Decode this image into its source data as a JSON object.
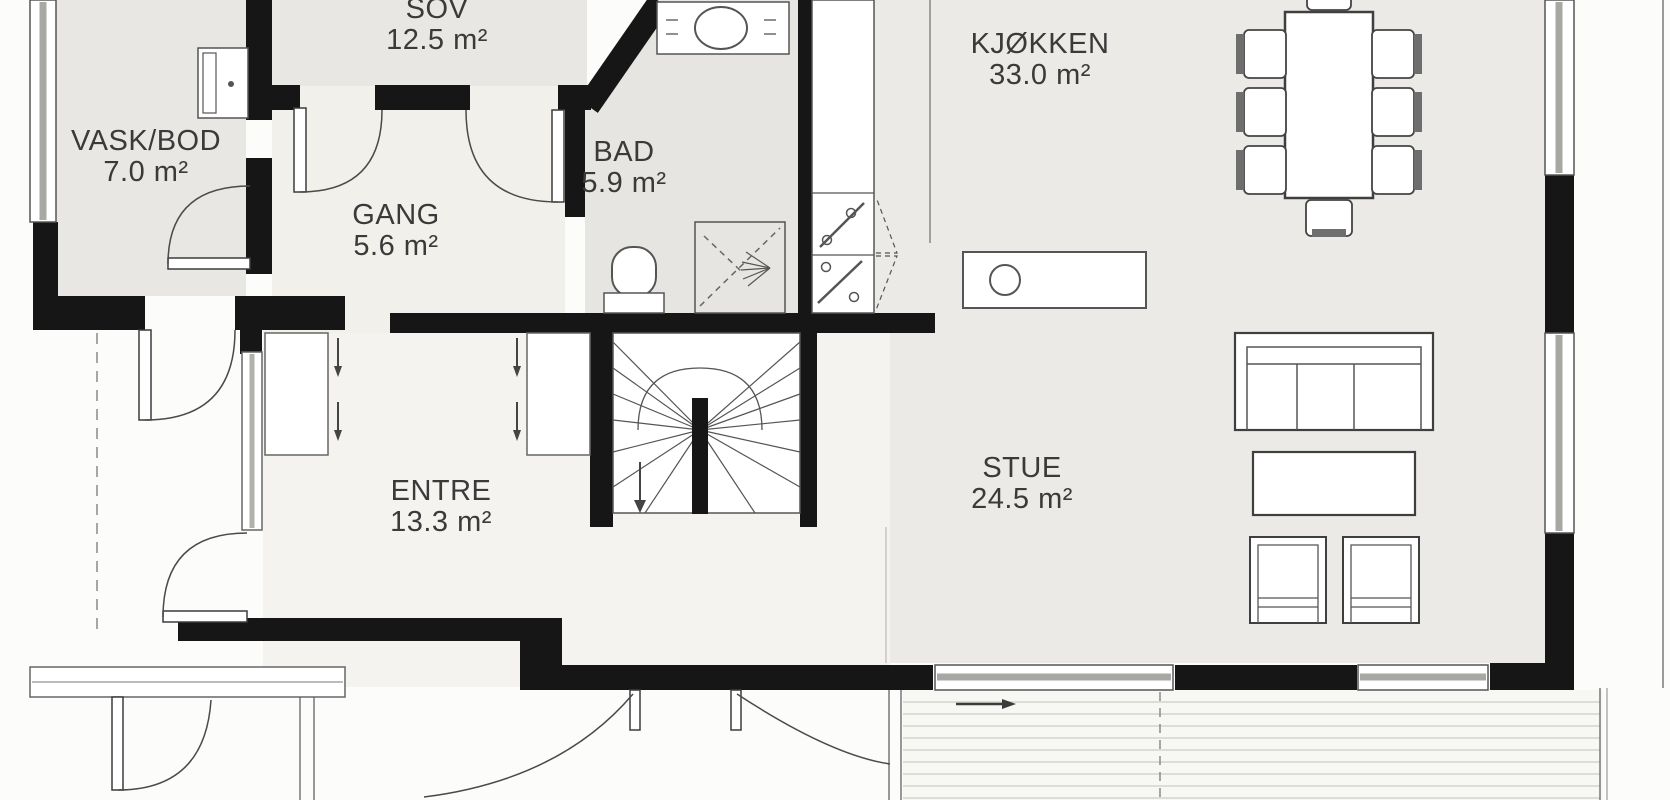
{
  "rooms": [
    {
      "name": "VASK/BOD",
      "area": "7.0 m²"
    },
    {
      "name": "SOV",
      "area": "12.5 m²"
    },
    {
      "name": "GANG",
      "area": "5.6 m²"
    },
    {
      "name": "BAD",
      "area": "5.9 m²"
    },
    {
      "name": "KJØKKEN",
      "area": "33.0 m²"
    },
    {
      "name": "ENTRE",
      "area": "13.3 m²"
    },
    {
      "name": "STUE",
      "area": "24.5 m²"
    }
  ],
  "colors": {
    "wall": "#161616",
    "room_floor": "#e8e7e3",
    "open_floor": "#ebeae6",
    "hall_floor": "#f3f2ee",
    "deck_line": "#ccccc8"
  },
  "furniture_icons": [
    "dining-table-icon",
    "dining-chair-icon",
    "kitchen-island-icon",
    "kitchen-sink-icon",
    "cooktop-icon",
    "sofa-icon",
    "coffee-table-icon",
    "armchair-icon",
    "toilet-icon",
    "shower-icon",
    "bathroom-vanity-icon",
    "washer-icon",
    "stairs-icon",
    "wardrobe-icon",
    "terrace-deck-icon",
    "door-swing-icon",
    "window-icon"
  ]
}
